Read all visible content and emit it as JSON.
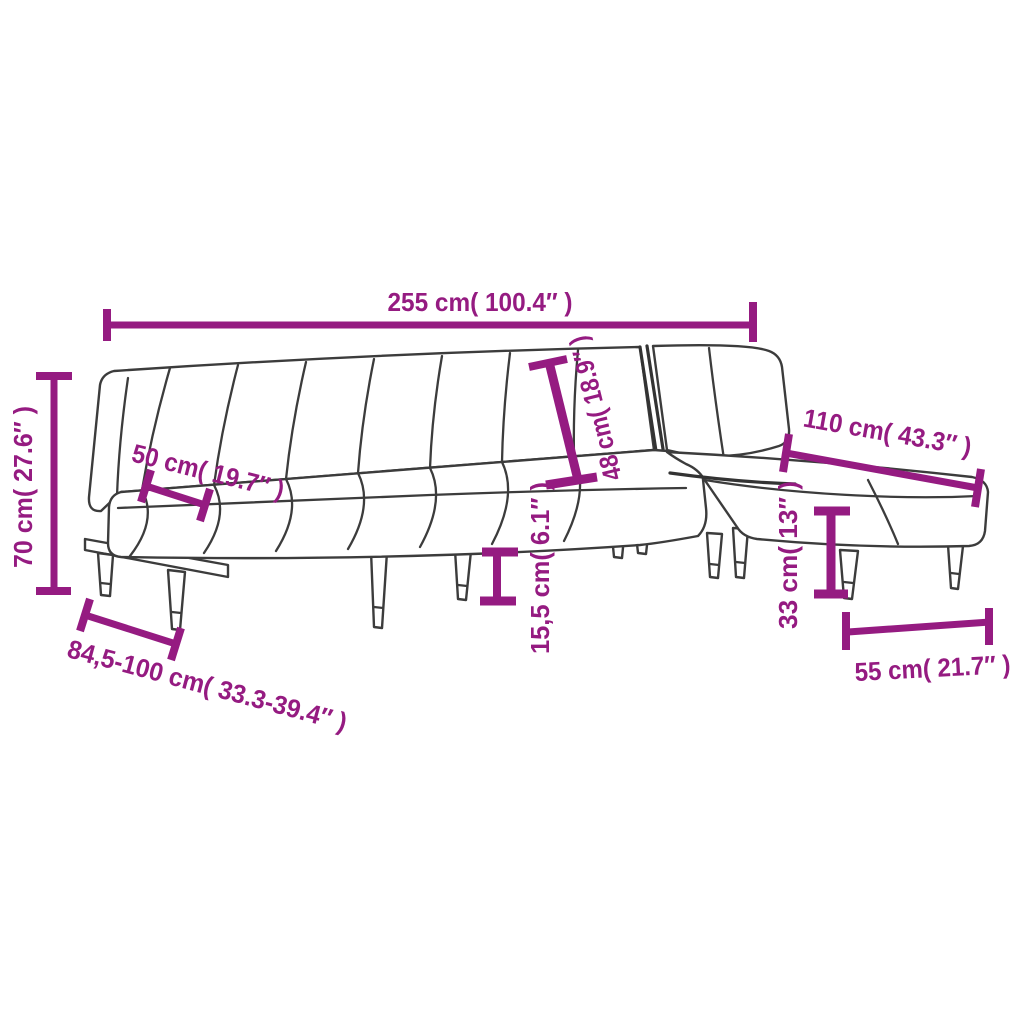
{
  "page": {
    "title": "L-shaped sofa bed dimension diagram",
    "background": "#ffffff"
  },
  "diagram": {
    "type": "product-dimension-diagram",
    "subject": "l-shaped-sofa-bed-line-drawing",
    "accent_color": "#951b81",
    "line_color": "#3c3c3c",
    "dimensions": [
      {
        "id": "total-length",
        "label": "255 cm( 100.4″ )"
      },
      {
        "id": "back-height",
        "label": "70 cm( 27.6″ )"
      },
      {
        "id": "seat-depth",
        "label": "50 cm( 19.7″ )"
      },
      {
        "id": "chaise-length",
        "label": "110 cm( 43.3″ )"
      },
      {
        "id": "backrest-panel-height",
        "label": "48 cm( 18.9″ )"
      },
      {
        "id": "ground-clearance",
        "label": "15,5 cm( 6.1″ )"
      },
      {
        "id": "seat-height",
        "label": "33 cm( 13″ )"
      },
      {
        "id": "depth-range",
        "label": "84,5-100 cm( 33.3-39.4″ )"
      },
      {
        "id": "chaise-width",
        "label": "55 cm( 21.7″ )"
      }
    ]
  }
}
